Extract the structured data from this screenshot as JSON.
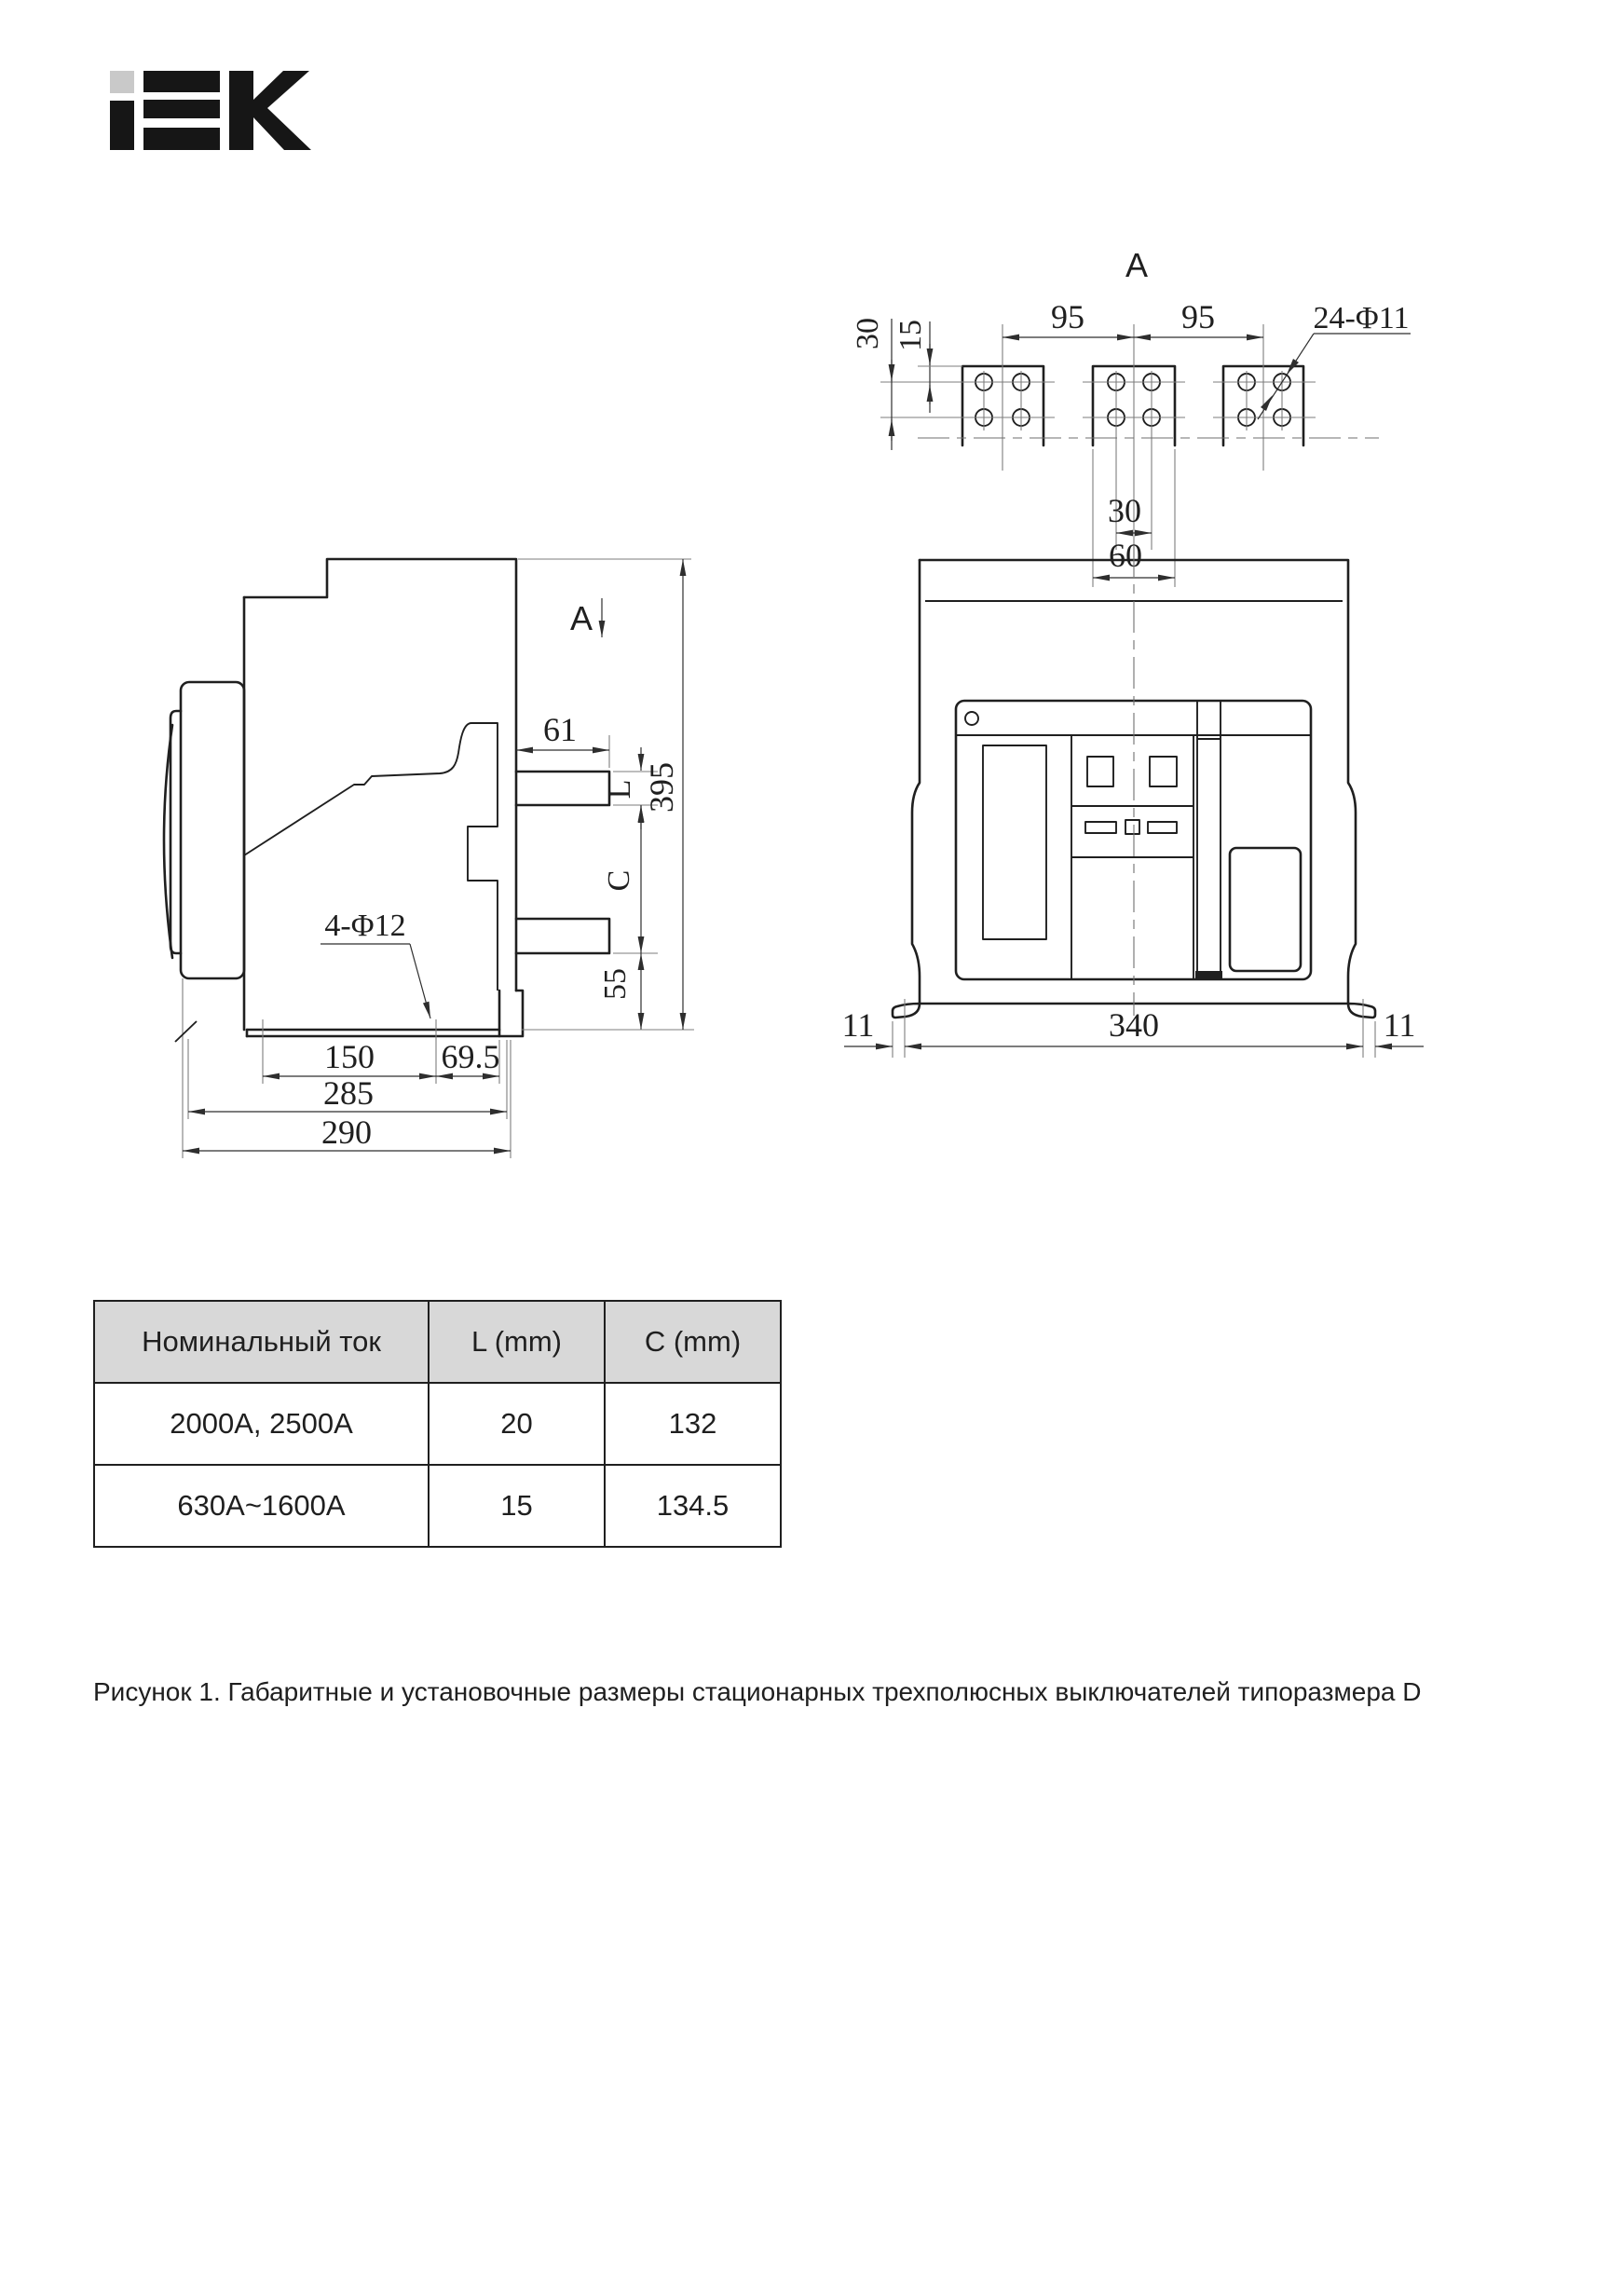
{
  "logo": {
    "alt": "IEK"
  },
  "colors": {
    "ink": "#1f1f1f",
    "extension_line": "#7d7d7d",
    "table_header_bg": "#d8d8d8",
    "logo_gray": "#c9c9c9",
    "logo_black": "#161616"
  },
  "section_view": {
    "label": "A",
    "dim_pitch_left": "95",
    "dim_pitch_right": "95",
    "dim_edge": "30",
    "dim_hole_offset": "15",
    "dim_holes_note": "24-Φ11",
    "dim_hole_span": "30",
    "dim_pad_width": "60"
  },
  "side_view": {
    "section_label": "A",
    "dim_lug_len": "61",
    "dim_lug_thick": "L",
    "dim_height": "395",
    "dim_gap": "C",
    "dim_base_offset": "55",
    "dim_holes_note": "4-Φ12",
    "dim_hole_pitch": "150",
    "dim_rear": "69.5",
    "dim_depth1": "285",
    "dim_depth2": "290"
  },
  "front_view": {
    "dim_foot_left": "11",
    "dim_width": "340",
    "dim_foot_right": "11"
  },
  "table": {
    "headers": [
      "Номинальный ток",
      "L (mm)",
      "C (mm)"
    ],
    "rows": [
      [
        "2000А, 2500А",
        "20",
        "132"
      ],
      [
        "630А~1600А",
        "15",
        "134.5"
      ]
    ]
  },
  "caption": "Рисунок 1. Габаритные и установочные размеры стационарных трехполюсных выключателей типоразмера D"
}
